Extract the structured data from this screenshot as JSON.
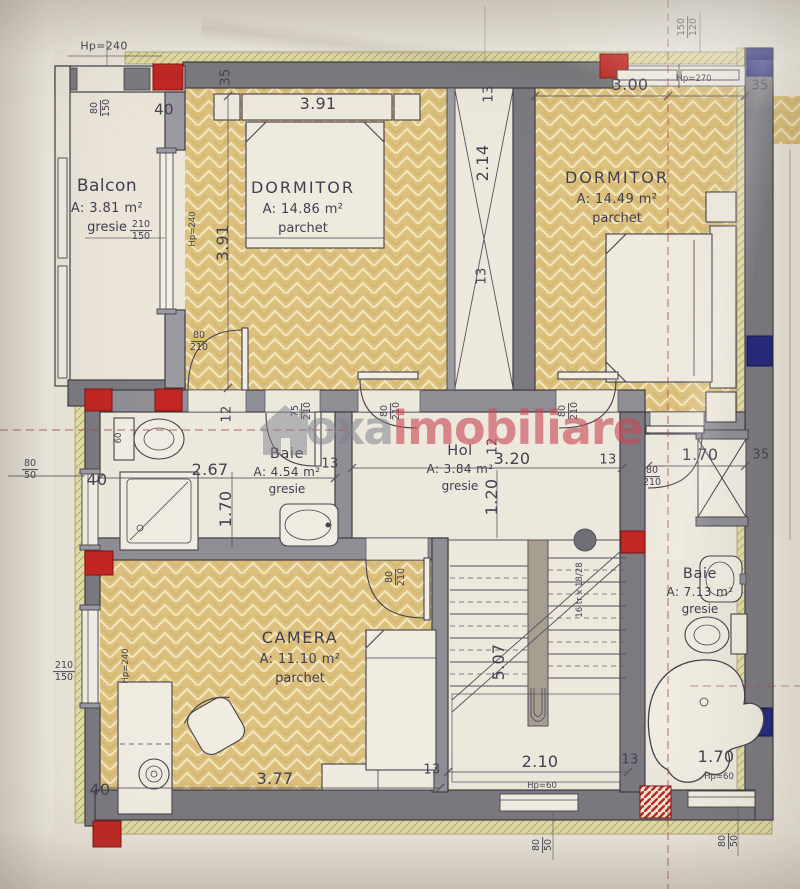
{
  "watermark": {
    "brand_gray": "oxa",
    "brand_red": "imobiliare"
  },
  "rooms": {
    "balcon": {
      "name": "Balcon",
      "area": "A: 3.81 m²",
      "floor": "gresie"
    },
    "dormitor1": {
      "name": "DORMITOR",
      "area": "A: 14.86 m²",
      "floor": "parchet"
    },
    "dormitor2": {
      "name": "DORMITOR",
      "area": "A: 14.49 m²",
      "floor": "parchet"
    },
    "baie1": {
      "name": "Baie",
      "area": "A: 4.54 m²",
      "floor": "gresie"
    },
    "hol": {
      "name": "Hol",
      "area": "A: 3.84 m²",
      "floor": "gresie"
    },
    "camera": {
      "name": "CAMERA",
      "area": "A: 11.10 m²",
      "floor": "parchet"
    },
    "baie2": {
      "name": "Baie",
      "area": "A: 7.13 m²",
      "floor": "gresie"
    }
  },
  "dimensions": {
    "dormitor1_width": "3.91",
    "dormitor1_depth": "3.91",
    "dormitor2_width": "3.00",
    "shaft_height": "2.14",
    "baie1_width": "2.67",
    "baie1_depth": "1.70",
    "hol_width": "3.20",
    "hol_depth": "1.20",
    "camera_width": "3.77",
    "stair_width": "2.10",
    "stair_flight": "5.07",
    "baie2_width_top": "1.70",
    "baie2_width_bottom": "1.70"
  },
  "wall_marks": {
    "m35_top_left": "35",
    "m35_top_right": "35",
    "m35_right": "35",
    "m40_top": "40",
    "m40_left": "40",
    "m40_bottom": "40",
    "m13_shaft_top": "13",
    "m13_shaft_bottom": "13",
    "m13_hol_left": "13",
    "m13_hol_right": "13",
    "m13_camera": "13",
    "m13_stairs": "13",
    "m12_baie1": "12",
    "m12_hol": "12"
  },
  "openings": {
    "hp240_top": "Hp=240",
    "hp240_balcony": "Hp=240",
    "hp240_camera": "Hp=240",
    "hp270": "Hp=270",
    "hp60_left": "Hp=60",
    "hp60_right": "Hp=60",
    "w80_150": {
      "top": "80",
      "bottom": "150"
    },
    "w210_150_balcony": {
      "top": "210",
      "bottom": "150"
    },
    "w210_150_camera": {
      "top": "210",
      "bottom": "150"
    },
    "w150_120": {
      "top": "150",
      "bottom": "120"
    },
    "w80_50_left": {
      "top": "80",
      "bottom": "50"
    },
    "w80_50_bottom_left": {
      "top": "80",
      "bottom": "50"
    },
    "w80_50_bottom_right": {
      "top": "80",
      "bottom": "50"
    },
    "d80_210_dormitor1": {
      "top": "80",
      "bottom": "210"
    },
    "d80_210_hol_left": {
      "top": "80",
      "bottom": "210"
    },
    "d80_210_hol_right": {
      "top": "80",
      "bottom": "210"
    },
    "d80_210_camera": {
      "top": "80",
      "bottom": "210"
    },
    "d80_210_baie2": {
      "top": "80",
      "bottom": "210"
    },
    "d75_210": {
      "top": "75",
      "bottom": "210"
    },
    "toilet_offset": "60"
  },
  "stairs": {
    "note": "16 tr x 18/28"
  }
}
